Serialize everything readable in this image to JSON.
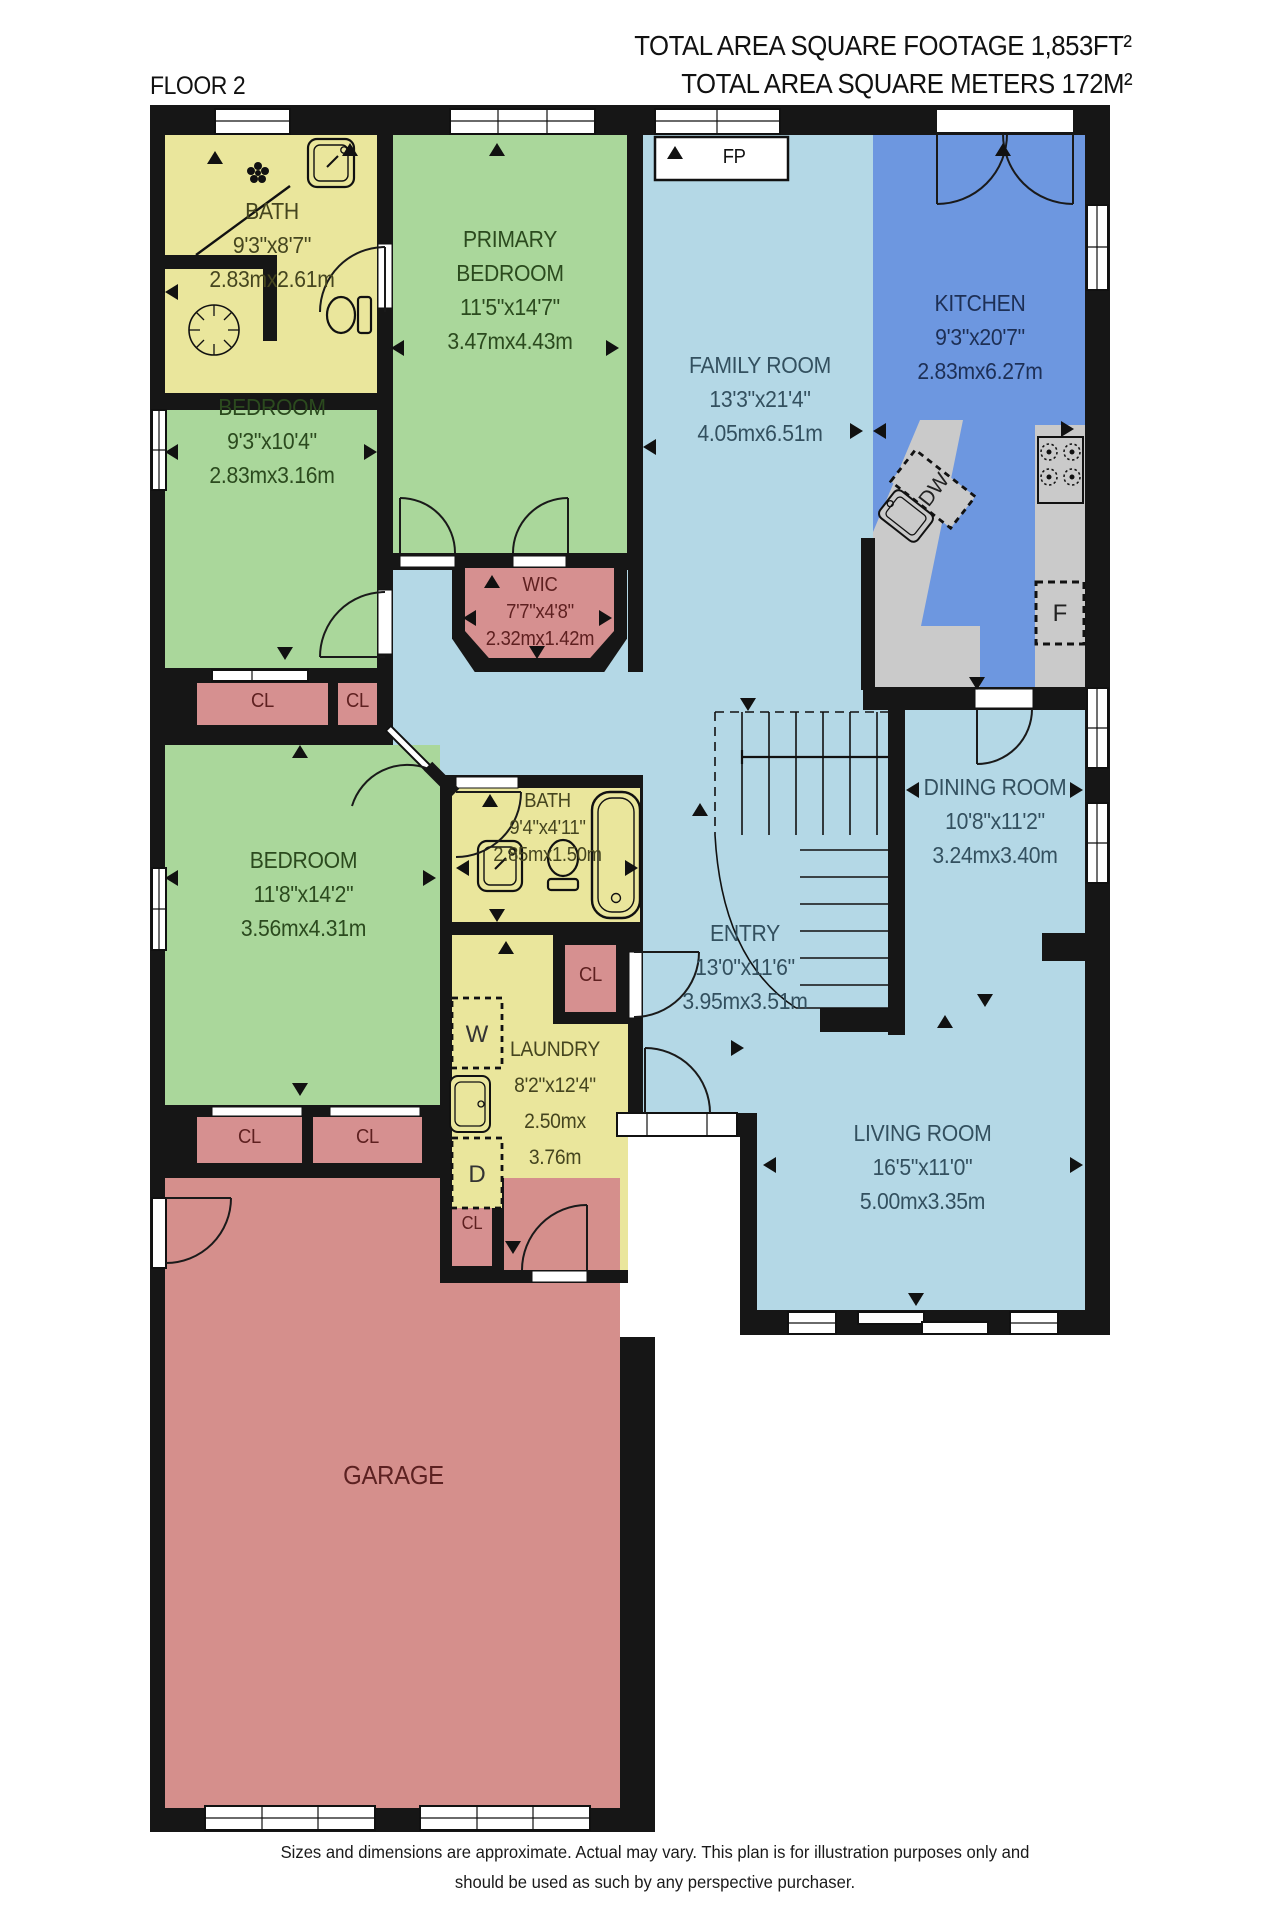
{
  "header": {
    "total_sqft": "TOTAL AREA SQUARE FOOTAGE 1,853FT²",
    "total_sqm": "TOTAL AREA SQUARE METERS 172M²",
    "floor_label": "FLOOR 2"
  },
  "rooms": {
    "bath1": {
      "name": "BATH",
      "dims_ft": "9'3\"x8'7\"",
      "dims_m": "2.83mx2.61m"
    },
    "primary": {
      "name": "PRIMARY BEDROOM",
      "dims_ft": "11'5\"x14'7\"",
      "dims_m": "3.47mx4.43m"
    },
    "family": {
      "name": "FAMILY ROOM",
      "dims_ft": "13'3\"x21'4\"",
      "dims_m": "4.05mx6.51m"
    },
    "kitchen": {
      "name": "KITCHEN",
      "dims_ft": "9'3\"x20'7\"",
      "dims_m": "2.83mx6.27m"
    },
    "bedroom1": {
      "name": "BEDROOM",
      "dims_ft": "9'3\"x10'4\"",
      "dims_m": "2.83mx3.16m"
    },
    "wic": {
      "name": "WIC",
      "dims_ft": "7'7\"x4'8\"",
      "dims_m": "2.32mx1.42m"
    },
    "bedroom2": {
      "name": "BEDROOM",
      "dims_ft": "11'8\"x14'2\"",
      "dims_m": "3.56mx4.31m"
    },
    "bath2": {
      "name": "BATH",
      "dims_ft": "9'4\"x4'11\"",
      "dims_m": "2.85mx1.50m"
    },
    "laundry": {
      "name": "LAUNDRY",
      "dims_ft": "8'2\"x12'4\"",
      "dims_m1": "2.50mx",
      "dims_m2": "3.76m"
    },
    "entry": {
      "name": "ENTRY",
      "dims_ft": "13'0\"x11'6\"",
      "dims_m": "3.95mx3.51m"
    },
    "dining": {
      "name": "DINING ROOM",
      "dims_ft": "10'8\"x11'2\"",
      "dims_m": "3.24mx3.40m"
    },
    "living": {
      "name": "LIVING ROOM",
      "dims_ft": "16'5\"x11'0\"",
      "dims_m": "5.00mx3.35m"
    },
    "garage": {
      "name": "GARAGE"
    }
  },
  "labels": {
    "fireplace": "FP",
    "dishwasher": "DW",
    "fridge": "F",
    "washer": "W",
    "dryer": "D",
    "closet": "CL"
  },
  "footer": {
    "line1": "Sizes and dimensions are approximate. Actual may vary. This plan is for illustration purposes only and",
    "line2": "should be used as such by any perspective purchaser."
  },
  "colors": {
    "wall": "#161616",
    "floor_blue": "#b4d8e6",
    "kitchen_blue": "#6d97e0",
    "bedroom_green": "#aad79b",
    "bath_yellow": "#eae69c",
    "closet_pink": "#d69090",
    "garage_pink": "#d58f8c",
    "counter_gray": "#cacaca"
  }
}
